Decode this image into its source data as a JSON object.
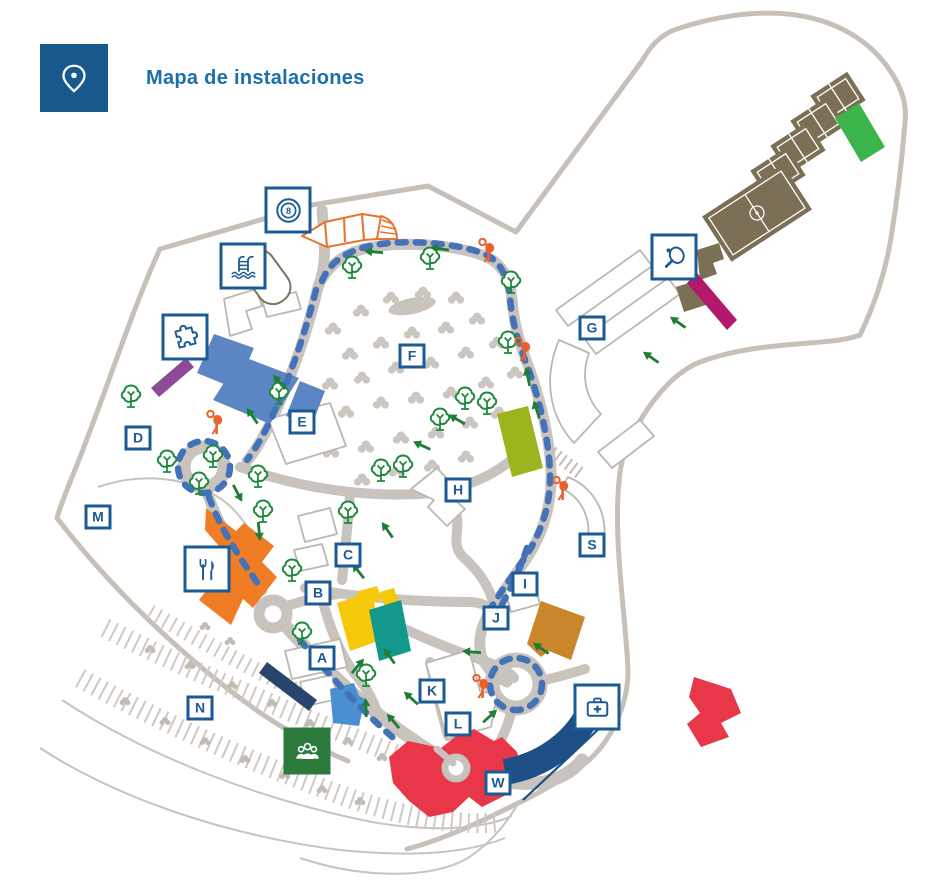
{
  "header": {
    "title": "Mapa de instalaciones"
  },
  "map": {
    "markers": [
      {
        "letter": "A",
        "x": 322,
        "y": 658
      },
      {
        "letter": "B",
        "x": 318,
        "y": 593
      },
      {
        "letter": "C",
        "x": 348,
        "y": 555
      },
      {
        "letter": "D",
        "x": 138,
        "y": 438
      },
      {
        "letter": "E",
        "x": 302,
        "y": 422
      },
      {
        "letter": "F",
        "x": 412,
        "y": 356
      },
      {
        "letter": "G",
        "x": 592,
        "y": 328
      },
      {
        "letter": "H",
        "x": 458,
        "y": 490
      },
      {
        "letter": "I",
        "x": 525,
        "y": 584
      },
      {
        "letter": "J",
        "x": 496,
        "y": 618
      },
      {
        "letter": "K",
        "x": 432,
        "y": 691
      },
      {
        "letter": "L",
        "x": 458,
        "y": 724
      },
      {
        "letter": "M",
        "x": 98,
        "y": 517
      },
      {
        "letter": "N",
        "x": 200,
        "y": 708
      },
      {
        "letter": "S",
        "x": 592,
        "y": 545
      },
      {
        "letter": "W",
        "x": 498,
        "y": 783
      }
    ],
    "facilities": [
      {
        "id": "billiards",
        "icon": "billiards-icon",
        "x": 288,
        "y": 210
      },
      {
        "id": "swimming-pool",
        "icon": "pool-icon",
        "x": 243,
        "y": 266
      },
      {
        "id": "miniclub",
        "icon": "puzzle-icon",
        "x": 185,
        "y": 337
      },
      {
        "id": "racket-club",
        "icon": "table-tennis-icon",
        "x": 674,
        "y": 257
      },
      {
        "id": "restaurant",
        "icon": "restaurant-icon",
        "x": 207,
        "y": 569
      },
      {
        "id": "medical-service",
        "icon": "first-aid-icon",
        "x": 597,
        "y": 707
      },
      {
        "id": "meeting-point",
        "icon": "people-icon",
        "x": 307,
        "y": 751,
        "style": "green"
      }
    ],
    "playgrounds": [
      [
        487,
        252
      ],
      [
        215,
        424
      ],
      [
        523,
        351
      ],
      [
        561,
        490
      ],
      [
        481,
        688
      ]
    ],
    "colors": {
      "brand_blue": "#1b5a94",
      "title_blue": "#1a6fad",
      "route_blue": "#4472b8",
      "tree_green": "#1f8a3d",
      "meeting_green": "#2b7a3c",
      "playground_orange": "#e8622d",
      "road_gray": "#c9c3bd",
      "building_orange": "#f07c25",
      "building_yellow": "#f5c80a",
      "building_teal": "#12998c",
      "building_red": "#e73748",
      "building_navy": "#1d4f86",
      "building_steelblue": "#5b86c3",
      "building_blue": "#4a90d0",
      "building_ochre": "#c9862b",
      "building_lime": "#9db41c",
      "building_green": "#3bb54a",
      "building_magenta": "#b3186c",
      "building_plum": "#8e4a96",
      "court_olive": "#7b7055"
    }
  }
}
